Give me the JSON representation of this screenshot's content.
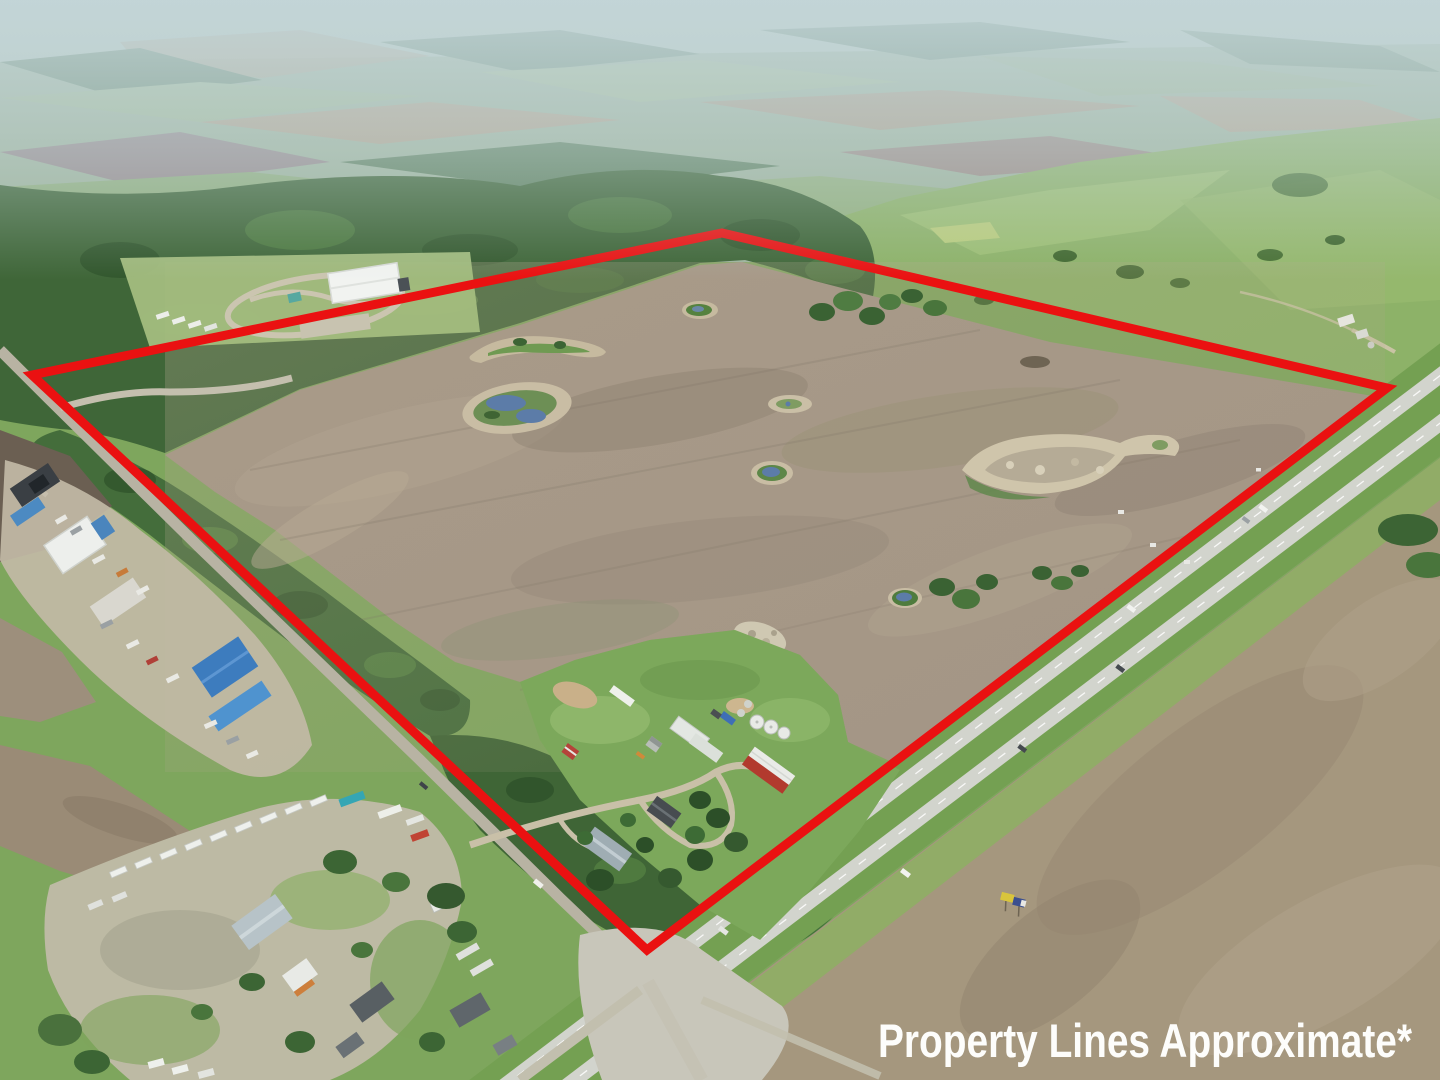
{
  "disclaimer": {
    "text": "Property Lines Approximate*",
    "color": "#fdfdfb"
  },
  "boundary": {
    "points": "32,375 722,233 1387,388 647,950",
    "color": "#ea1111",
    "stroke_width": 9
  },
  "palette": {
    "boundary_red": "#ea1111",
    "barn_red": "#b23a2e",
    "shed_red": "#b5433a",
    "roof_blue": "#4285c4",
    "container_teal": "#35a6b4",
    "water_blue": "#5c7ca8",
    "plowed_field_brown": "#a39585",
    "forest_green": "#3f6638",
    "pasture_green": "#8db268",
    "highway_gray": "#d2d4cd",
    "billboard_yellow": "#d9c53c",
    "billboard_blue": "#3b4f8f",
    "haze_blue": "#c4d6da"
  }
}
